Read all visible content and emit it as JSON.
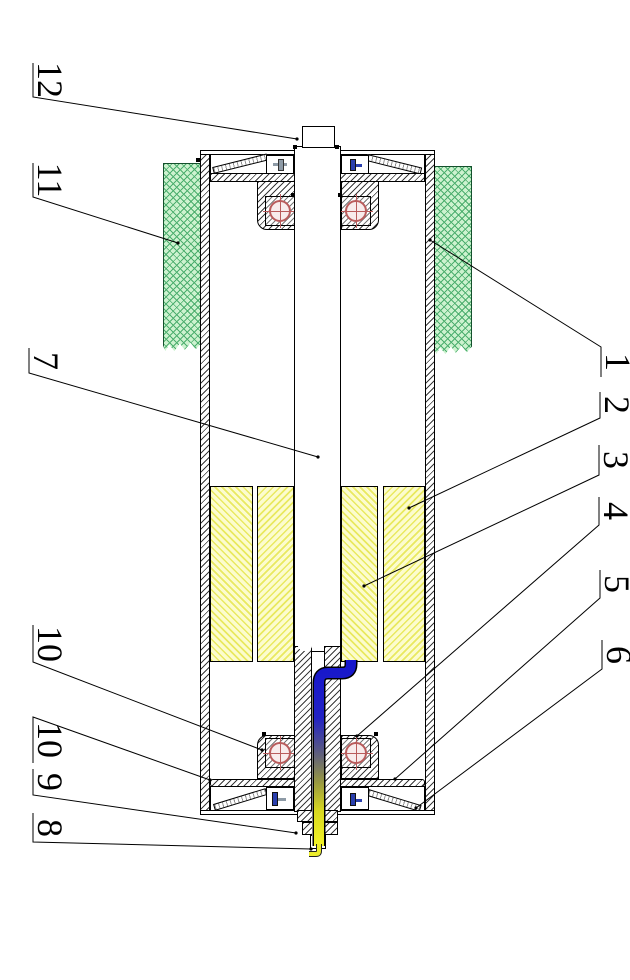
{
  "figure": {
    "kind": "patent-style sectional drawing of a motorized drum roller, rotated 90°",
    "callouts": [
      {
        "text": "12",
        "points": [
          [
            33,
            63
          ],
          [
            33,
            97
          ],
          [
            297,
            139
          ]
        ]
      },
      {
        "text": "11",
        "points": [
          [
            33,
            163
          ],
          [
            33,
            197
          ],
          [
            178,
            243
          ]
        ]
      },
      {
        "text": "7",
        "points": [
          [
            29,
            348
          ],
          [
            29,
            373
          ],
          [
            318,
            457
          ]
        ]
      },
      {
        "text": "10",
        "points": [
          [
            33,
            625
          ],
          [
            33,
            662
          ],
          [
            262,
            750
          ]
        ]
      },
      {
        "text": "10",
        "points": [
          [
            33,
            763
          ],
          [
            33,
            717
          ],
          [
            210,
            780
          ]
        ]
      },
      {
        "text": "9",
        "points": [
          [
            33,
            769
          ],
          [
            33,
            795
          ],
          [
            296,
            833
          ]
        ]
      },
      {
        "text": "8",
        "points": [
          [
            33,
            813
          ],
          [
            33,
            842
          ],
          [
            311,
            849
          ]
        ]
      },
      {
        "text": "1",
        "points": [
          [
            601,
            377
          ],
          [
            601,
            347
          ],
          [
            430,
            240
          ]
        ]
      },
      {
        "text": "2",
        "points": [
          [
            600,
            392
          ],
          [
            600,
            418
          ],
          [
            409,
            508
          ]
        ]
      },
      {
        "text": "3",
        "points": [
          [
            599,
            445
          ],
          [
            599,
            475
          ],
          [
            364,
            586
          ]
        ]
      },
      {
        "text": "4",
        "points": [
          [
            599,
            497
          ],
          [
            599,
            525
          ],
          [
            357,
            736
          ]
        ]
      },
      {
        "text": "5",
        "points": [
          [
            600,
            570
          ],
          [
            600,
            598
          ],
          [
            395,
            779
          ]
        ]
      },
      {
        "text": "6",
        "points": [
          [
            602,
            640
          ],
          [
            602,
            669
          ],
          [
            416,
            808
          ]
        ]
      }
    ],
    "colors": {
      "outline": "#000000",
      "metal_line": "#3a3a3a",
      "green_fill": "#cdf2cf",
      "green_line": "#4cae6e",
      "yellow_fill": "#fcfcce",
      "yellow_line": "#e9e960",
      "bearing_red": "#b95c5c",
      "cable_blue": "#1616cc",
      "cable_yellow": "#f0f028",
      "fitting_blue": "#2a3fae",
      "fitting_grey": "#8d9aa6"
    }
  }
}
